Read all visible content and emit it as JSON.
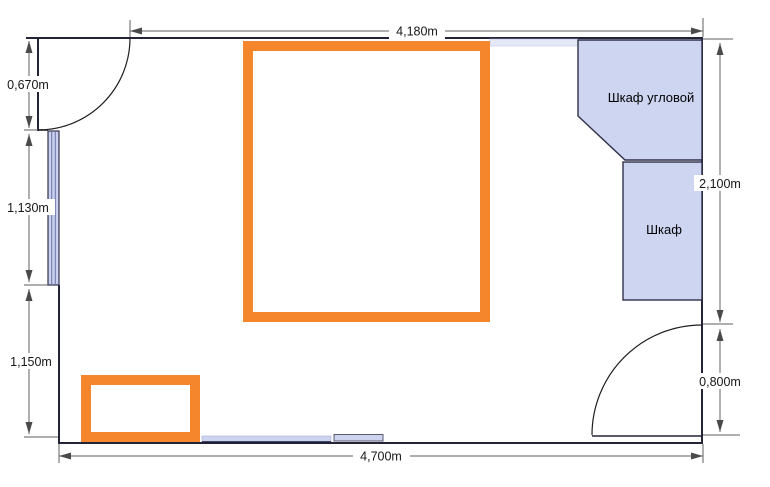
{
  "floor_plan": {
    "dimensions": {
      "top": "4,180m",
      "bottom": "4,700m",
      "left_door": "0,670m",
      "left_window": "1,130m",
      "left_lower": "1,150m",
      "right_upper": "2,100m",
      "right_door": "0,800m"
    },
    "furniture": {
      "corner_wardrobe": "Шкаф угловой",
      "wardrobe": "Шкаф"
    },
    "colors": {
      "highlight_orange": "#f6862b",
      "furniture_fill": "#cdd5f1",
      "window_fill": "#c9d1ef",
      "strip_fill": "#ccd4f0",
      "top_strip_fill": "#e4e8f7",
      "wall": "#23233a",
      "dimension_line": "#5f5f5f",
      "text": "#161616"
    }
  }
}
